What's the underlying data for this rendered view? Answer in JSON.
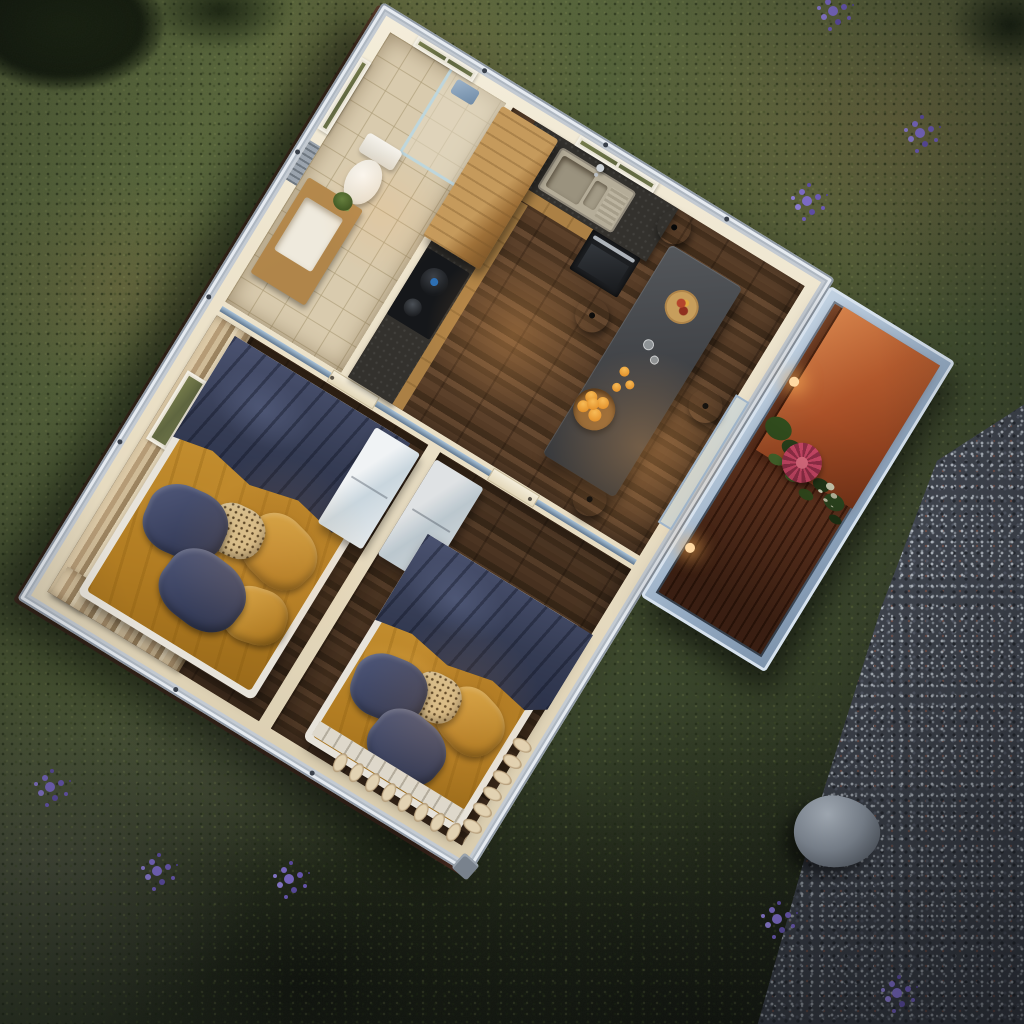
{
  "meta": {
    "scene_label": "Aerial dusk 3D render of a prefab container home with open-roof interior view",
    "view": "top-down oblique",
    "house_rotation_deg": 31.5
  },
  "environment": {
    "lawn": {
      "label": "Grass lawn",
      "base_color": "#57653b",
      "dry_patch_color": "#857548"
    },
    "gravel": {
      "label": "Gravel yard",
      "base_color": "#434854"
    },
    "boulder": {
      "label": "Grey boulder",
      "color": "#8b949e"
    },
    "lavender": {
      "label": "Lavender flower cluster",
      "count": 8,
      "color": "#7b6ac4"
    },
    "shrub": {
      "label": "Dark shrub",
      "color": "#16200e"
    }
  },
  "house": {
    "label": "Two-bedroom container home",
    "frame": {
      "label": "Steel container frame",
      "color": "#c3cad2",
      "beam_color": "#7e96ac"
    },
    "wall_color": "#efe6d1",
    "floor_wood_color": "#503823",
    "rooms": {
      "bathroom": {
        "label": "Bathroom",
        "items": {
          "toilet": "Toilet",
          "vanity": "Wood vanity with sink",
          "shower": "Glass shower",
          "plant": "Potted plant",
          "window": "Window",
          "vent": "Wall vent"
        }
      },
      "kitchen": {
        "label": "Kitchen",
        "items": {
          "counter": "L-shaped dark stone counter",
          "sink": "Inset sink with drainboard",
          "faucet": "Chrome faucet",
          "window": "Two-pane window",
          "cabinet": "Oak cabinet",
          "cooktop": "Cooktop with kettle and pot",
          "oven": "Built-in oven"
        }
      },
      "dining": {
        "label": "Dining area",
        "items": {
          "table": "Grey dining table",
          "stools": "Black round stools",
          "stool_count": 4,
          "plate": "Serving plate",
          "bowl": "Bowl of oranges",
          "oranges": "Loose oranges",
          "glasses": "Drinking glasses"
        }
      },
      "bedroom1": {
        "label": "Bedroom 1",
        "items": {
          "bed": "Double bed",
          "duvet": "Navy duvet",
          "blanket": "Mustard throw",
          "pillows": "Navy, mustard and patterned pillows",
          "curtains": "Beige curtains",
          "window": "Window"
        }
      },
      "bedroom2": {
        "label": "Bedroom 2",
        "items": {
          "bed": "Double bed",
          "duvet": "Navy duvet",
          "blanket": "Mustard throw",
          "pillows": "Navy, mustard and patterned pillows",
          "curtains": "Beige curtains"
        }
      },
      "hallway": {
        "label": "Hallway",
        "items": {
          "doors": "Interior doors"
        }
      },
      "wardrobe": {
        "label": "White wardrobe unit"
      },
      "deck": {
        "label": "Side deck",
        "items": {
          "decking": "Hardwood plank decking",
          "feature_wall": "Terracotta feature wall",
          "planter": "Planter with pink bromeliad and foliage",
          "lights": "Warm deck lights"
        }
      }
    },
    "bedding_colors": {
      "duvet": "#353c54",
      "blanket": "#c08a2e",
      "pillow_pattern": "#d3bd8d"
    }
  }
}
